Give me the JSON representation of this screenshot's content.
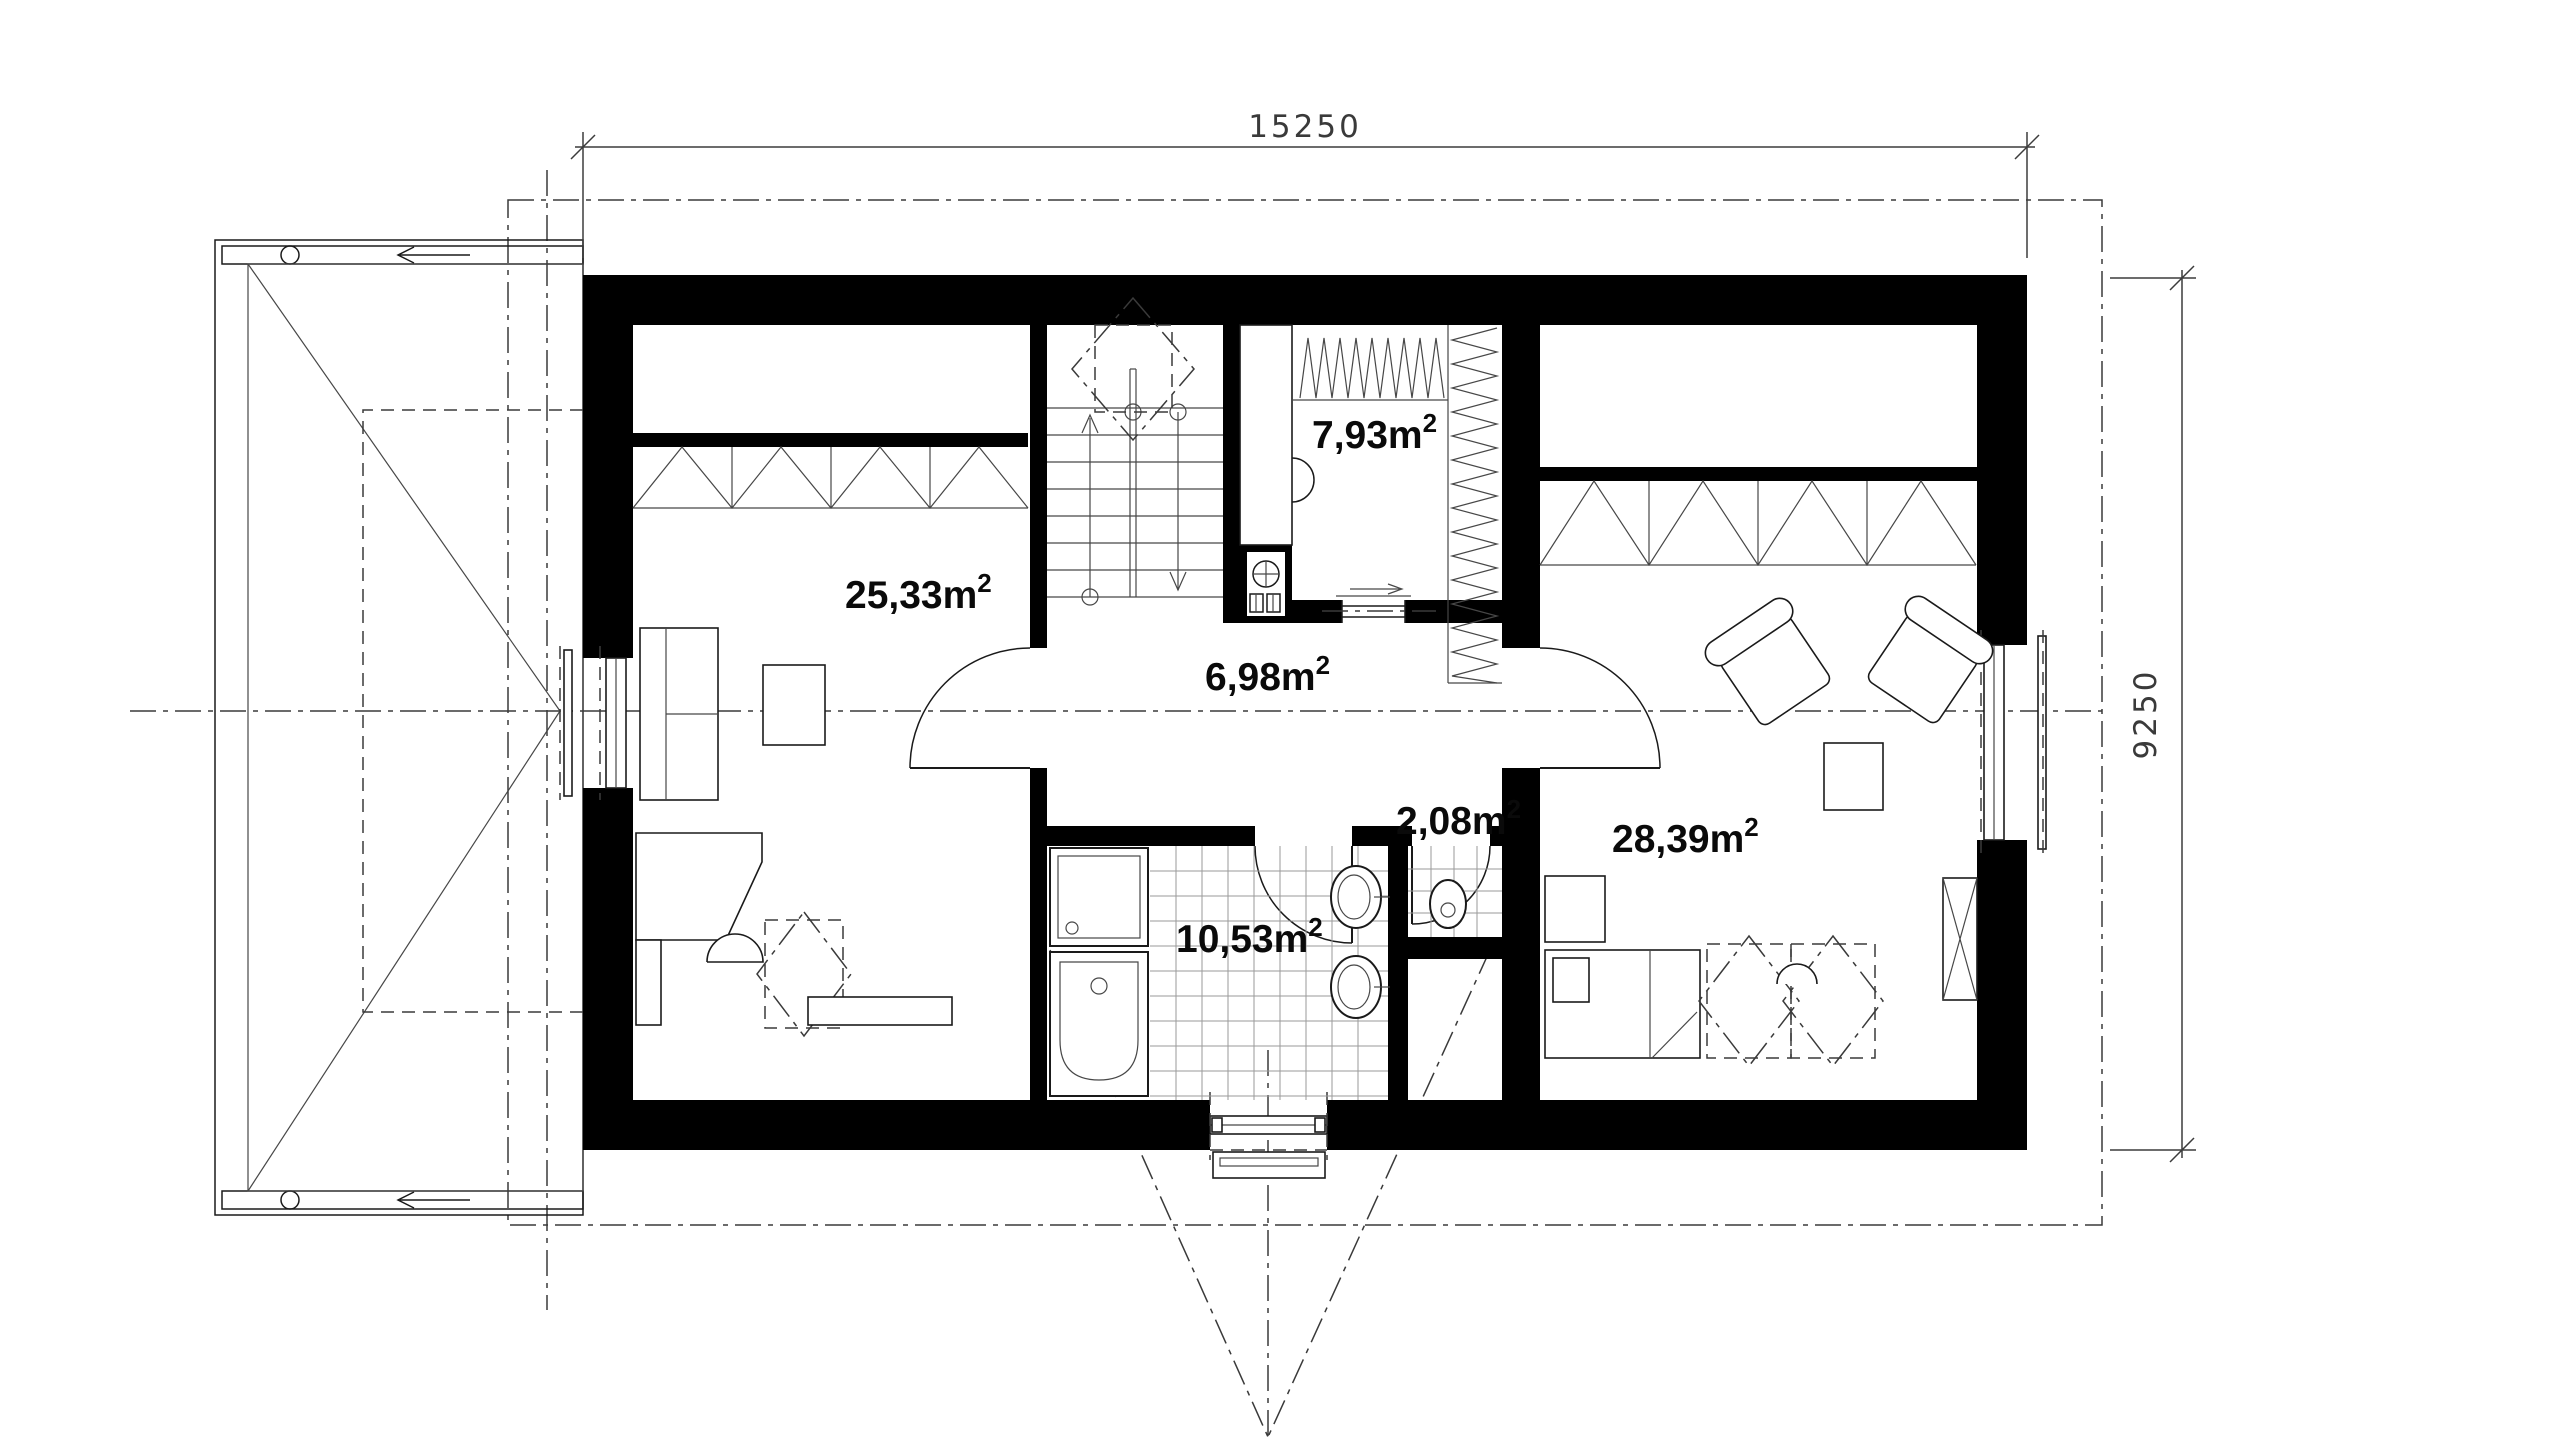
{
  "dimensions": {
    "width": "15250",
    "height": "9250"
  },
  "unit": {
    "symbol": "m",
    "exponent": "2"
  },
  "rooms": {
    "bedroom_left": {
      "area": "25,33"
    },
    "wardrobe": {
      "area": "7,93"
    },
    "hall": {
      "area": "6,98"
    },
    "wc": {
      "area": "2,08"
    },
    "bedroom_right": {
      "area": "28,39"
    },
    "bathroom": {
      "area": "10,53"
    }
  },
  "colors": {
    "wall": "#000000",
    "line": "#1a1a1a",
    "tile_line": "#9a9a9a",
    "background": "#ffffff"
  }
}
